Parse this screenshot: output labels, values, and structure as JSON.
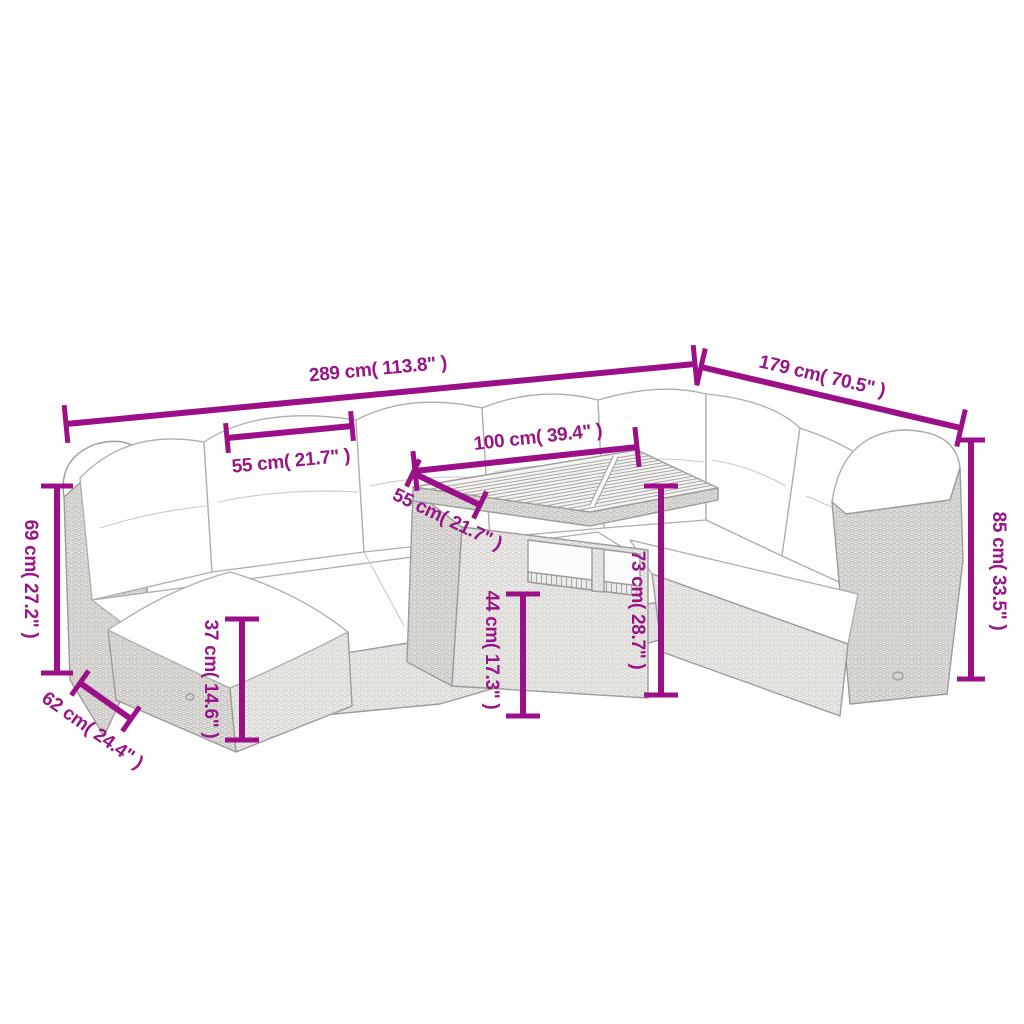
{
  "title": "Garden furniture set dimension diagram",
  "dimensions": {
    "total_width": "289 cm( 113.8\" )",
    "total_depth": "179 cm( 70.5\" )",
    "backrest_section_width": "55 cm( 21.7\" )",
    "table_top_width": "100 cm( 39.4\" )",
    "table_top_depth": "55 cm( 21.7\" )",
    "armrest_height": "69 cm( 27.2\" )",
    "seat_depth": "62 cm( 24.4\" )",
    "seat_height": "37 cm( 14.6\" )",
    "table_shelf_height": "44 cm( 17.3\" )",
    "table_height": "73 cm( 28.7\" )",
    "backrest_height": "85 cm( 33.5\" )"
  },
  "colors": {
    "dimension_color": "#981487",
    "line_art_color": "#9c9c9c"
  }
}
